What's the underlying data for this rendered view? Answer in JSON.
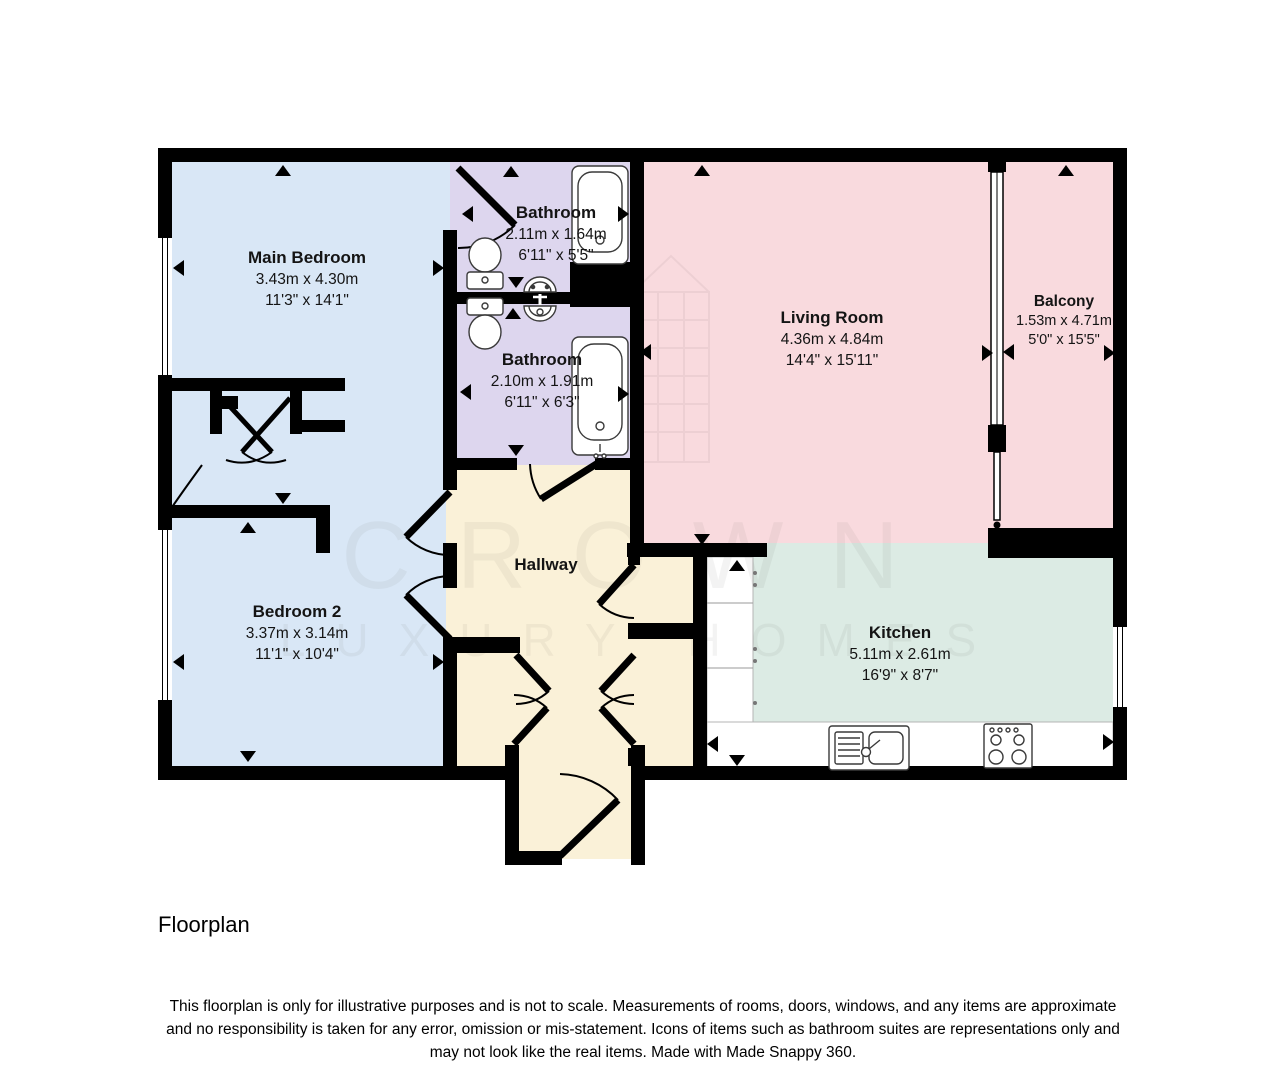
{
  "page": {
    "title": "Floorplan"
  },
  "watermark": {
    "line1": "CROWN",
    "line2": "LUXURY HOMES"
  },
  "rooms": [
    {
      "id": "main-bedroom",
      "name": "Main Bedroom",
      "metric": "3.43m x 4.30m",
      "imperial": "11'3\" x 14'1\"",
      "color": "#d9e7f6"
    },
    {
      "id": "bathroom-1",
      "name": "Bathroom",
      "metric": "2.11m x 1.64m",
      "imperial": "6'11\" x 5'5\"",
      "color": "#ddd6ee"
    },
    {
      "id": "bathroom-2",
      "name": "Bathroom",
      "metric": "2.10m x 1.91m",
      "imperial": "6'11\" x 6'3\"",
      "color": "#ddd6ee"
    },
    {
      "id": "living-room",
      "name": "Living Room",
      "metric": "4.36m x 4.84m",
      "imperial": "14'4\" x 15'11\"",
      "color": "#f9dade"
    },
    {
      "id": "balcony",
      "name": "Balcony",
      "metric": "1.53m x 4.71m",
      "imperial": "5'0\" x 15'5\"",
      "color": "#f9dade"
    },
    {
      "id": "bedroom-2",
      "name": "Bedroom 2",
      "metric": "3.37m x 3.14m",
      "imperial": "11'1\" x 10'4\"",
      "color": "#d9e7f6"
    },
    {
      "id": "hallway",
      "name": "Hallway",
      "metric": "",
      "imperial": "",
      "color": "#faf1d8"
    },
    {
      "id": "kitchen",
      "name": "Kitchen",
      "metric": "5.11m x 2.61m",
      "imperial": "16'9\" x 8'7\"",
      "color": "#dcebe4"
    }
  ],
  "icons": {
    "toilet": "svg-shape",
    "sink": "svg-shape",
    "bathtub": "svg-shape",
    "kitchen-sink": "svg-shape",
    "hob": "svg-shape",
    "window": "double-line",
    "door-swing": "arc",
    "direction-arrow": "triangle"
  },
  "footer": {
    "title": "Floorplan",
    "disclaimer_lines": [
      "This floorplan is only for illustrative purposes and is not to scale. Measurements of rooms, doors, windows, and any items are approximate",
      "and no responsibility is taken for any error, omission or mis-statement. Icons of items such as bathroom suites are representations only and",
      "may not look like the real items. Made with Made Snappy 360."
    ]
  }
}
